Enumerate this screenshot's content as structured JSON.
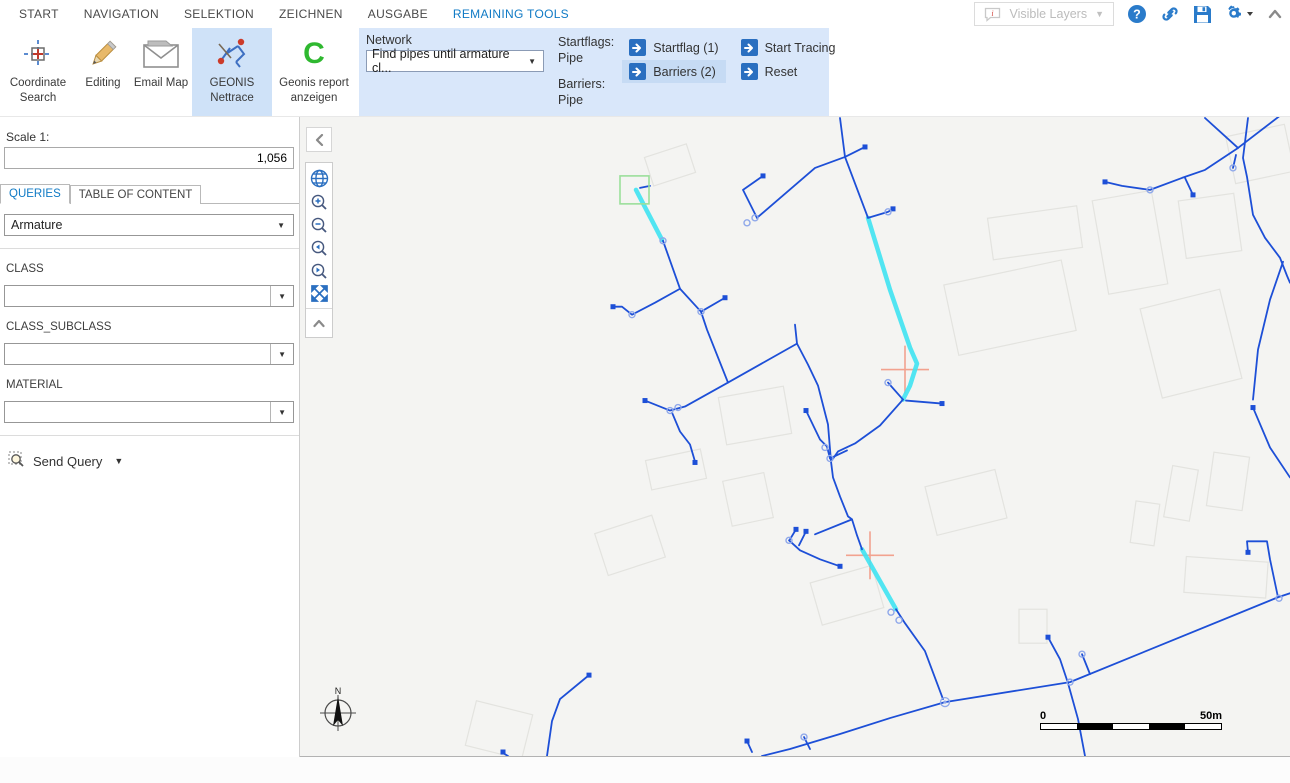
{
  "tabs": {
    "items": [
      "START",
      "NAVIGATION",
      "SELEKTION",
      "ZEICHNEN",
      "AUSGABE",
      "REMAINING TOOLS"
    ]
  },
  "titlebar": {
    "visible_layers_label": "Visible Layers"
  },
  "ribbon": {
    "tools": [
      {
        "label": "Coordinate Search"
      },
      {
        "label": "Editing"
      },
      {
        "label": "Email Map"
      },
      {
        "label": "GEONIS Nettrace"
      },
      {
        "label": "Geonis report anzeigen"
      }
    ],
    "geonis_c_letter": "C",
    "network": {
      "label": "Network",
      "dropdown_value": "Find pipes until armature cl...",
      "startflags_label": "Startflags:",
      "startflags_value": "Pipe",
      "barriers_label": "Barriers:",
      "barriers_value": "Pipe"
    },
    "buttons": [
      {
        "label": "Startflag (1)"
      },
      {
        "label": "Barriers (2)"
      },
      {
        "label": "Start Tracing"
      },
      {
        "label": "Reset"
      }
    ]
  },
  "left_panel": {
    "scale_label": "Scale 1:",
    "scale_value": "1,056",
    "tabs": [
      {
        "label": "QUERIES"
      },
      {
        "label": "TABLE OF CONTENT"
      }
    ],
    "query_select_value": "Armature",
    "fields": [
      {
        "label": "CLASS",
        "value": ""
      },
      {
        "label": "CLASS_SUBCLASS",
        "value": ""
      },
      {
        "label": "MATERIAL",
        "value": ""
      }
    ],
    "send_query_label": "Send Query"
  },
  "map": {
    "compass_label": "N",
    "scalebar": {
      "start": "0",
      "end": "50m"
    },
    "colors": {
      "line": "#1d4fd7",
      "cyan": "#3fe3f2",
      "circle": "#8fa8ea",
      "flag_green": "#9bdf9b",
      "barrier_red": "#f2a28f",
      "building": "#e3e3df"
    },
    "start_flag_box": {
      "x": 620,
      "y": 176,
      "w": 29,
      "h": 28
    },
    "crosshairs": [
      [
        905,
        370
      ],
      [
        870,
        556
      ]
    ],
    "cyan_lines": [
      [
        [
          636,
          190
        ],
        [
          662,
          240
        ]
      ],
      [
        [
          868,
          218
        ],
        [
          890,
          290
        ],
        [
          910,
          348
        ],
        [
          917,
          364
        ],
        [
          910,
          386
        ],
        [
          903,
          400
        ]
      ],
      [
        [
          862,
          550
        ],
        [
          896,
          610
        ]
      ]
    ],
    "blue_lines": [
      [
        [
          840,
          118
        ],
        [
          845,
          157
        ],
        [
          868,
          218
        ]
      ],
      [
        [
          845,
          157
        ],
        [
          815,
          168
        ],
        [
          757,
          218
        ]
      ],
      [
        [
          757,
          218
        ],
        [
          743,
          190
        ],
        [
          763,
          176
        ]
      ],
      [
        [
          845,
          157
        ],
        [
          865,
          147
        ]
      ],
      [
        [
          868,
          218
        ],
        [
          888,
          212
        ],
        [
          893,
          209
        ]
      ],
      [
        [
          663,
          241
        ],
        [
          680,
          289
        ],
        [
          701,
          312
        ],
        [
          707,
          330
        ],
        [
          728,
          383
        ]
      ],
      [
        [
          680,
          289
        ],
        [
          655,
          303
        ],
        [
          632,
          315
        ],
        [
          622,
          307
        ],
        [
          613,
          307
        ]
      ],
      [
        [
          701,
          312
        ],
        [
          725,
          298
        ]
      ],
      [
        [
          728,
          383
        ],
        [
          797,
          344
        ]
      ],
      [
        [
          795,
          325
        ],
        [
          797,
          344
        ],
        [
          808,
          365
        ],
        [
          818,
          386
        ],
        [
          828,
          425
        ],
        [
          831,
          462
        ]
      ],
      [
        [
          728,
          383
        ],
        [
          685,
          407
        ],
        [
          670,
          411
        ],
        [
          645,
          401
        ]
      ],
      [
        [
          672,
          413
        ],
        [
          680,
          432
        ],
        [
          690,
          445
        ],
        [
          695,
          462
        ]
      ],
      [
        [
          903,
          400
        ],
        [
          888,
          383
        ]
      ],
      [
        [
          906,
          401
        ],
        [
          942,
          404
        ]
      ],
      [
        [
          903,
          400
        ],
        [
          880,
          426
        ],
        [
          855,
          444
        ],
        [
          838,
          452
        ],
        [
          831,
          462
        ],
        [
          833,
          478
        ],
        [
          840,
          497
        ],
        [
          848,
          517
        ],
        [
          852,
          520
        ],
        [
          857,
          536
        ],
        [
          862,
          550
        ]
      ],
      [
        [
          852,
          520
        ],
        [
          815,
          535
        ]
      ],
      [
        [
          896,
          610
        ],
        [
          905,
          624
        ],
        [
          925,
          652
        ],
        [
          943,
          700
        ]
      ],
      [
        [
          789,
          541
        ],
        [
          800,
          551
        ],
        [
          820,
          560
        ],
        [
          840,
          567
        ]
      ],
      [
        [
          796,
          530
        ],
        [
          790,
          540
        ]
      ],
      [
        [
          806,
          532
        ],
        [
          799,
          546
        ]
      ],
      [
        [
          945,
          703
        ],
        [
          890,
          719
        ],
        [
          840,
          735
        ],
        [
          790,
          750
        ],
        [
          762,
          757
        ]
      ],
      [
        [
          945,
          703
        ],
        [
          1070,
          683
        ],
        [
          1278,
          598
        ]
      ],
      [
        [
          1278,
          598
        ],
        [
          1290,
          594
        ]
      ],
      [
        [
          1278,
          598
        ],
        [
          1270,
          560
        ],
        [
          1267,
          542
        ],
        [
          1247,
          542
        ],
        [
          1248,
          553
        ]
      ],
      [
        [
          1048,
          638
        ],
        [
          1060,
          660
        ],
        [
          1068,
          684
        ],
        [
          1078,
          720
        ],
        [
          1085,
          757
        ]
      ],
      [
        [
          1082,
          655
        ],
        [
          1086,
          665
        ],
        [
          1090,
          675
        ]
      ],
      [
        [
          589,
          676
        ],
        [
          560,
          700
        ],
        [
          552,
          722
        ],
        [
          547,
          757
        ]
      ],
      [
        [
          503,
          754
        ],
        [
          508,
          757
        ]
      ],
      [
        [
          747,
          742
        ],
        [
          752,
          753
        ]
      ],
      [
        [
          804,
          738
        ],
        [
          810,
          750
        ]
      ],
      [
        [
          1205,
          118
        ],
        [
          1238,
          148
        ]
      ],
      [
        [
          1238,
          148
        ],
        [
          1290,
          108
        ]
      ],
      [
        [
          1248,
          118
        ],
        [
          1243,
          158
        ],
        [
          1247,
          177
        ],
        [
          1253,
          215
        ],
        [
          1265,
          238
        ],
        [
          1280,
          258
        ],
        [
          1287,
          276
        ],
        [
          1290,
          283
        ]
      ],
      [
        [
          1283,
          262
        ],
        [
          1270,
          300
        ],
        [
          1258,
          350
        ],
        [
          1253,
          400
        ]
      ],
      [
        [
          1253,
          408
        ],
        [
          1270,
          448
        ],
        [
          1290,
          478
        ]
      ],
      [
        [
          1238,
          148
        ],
        [
          1205,
          170
        ],
        [
          1182,
          178
        ],
        [
          1150,
          190
        ],
        [
          1122,
          186
        ],
        [
          1105,
          182
        ]
      ],
      [
        [
          1185,
          178
        ],
        [
          1193,
          195
        ]
      ],
      [
        [
          1236,
          155
        ],
        [
          1233,
          168
        ]
      ],
      [
        [
          640,
          188
        ],
        [
          650,
          186
        ]
      ],
      [
        [
          806,
          411
        ],
        [
          820,
          440
        ],
        [
          827,
          447
        ],
        [
          830,
          459
        ]
      ],
      [
        [
          830,
          459
        ],
        [
          847,
          451
        ]
      ]
    ],
    "squares": [
      [
        865,
        147
      ],
      [
        893,
        209
      ],
      [
        763,
        176
      ],
      [
        725,
        298
      ],
      [
        613,
        307
      ],
      [
        645,
        401
      ],
      [
        695,
        463
      ],
      [
        942,
        404
      ],
      [
        806,
        411
      ],
      [
        589,
        676
      ],
      [
        503,
        753
      ],
      [
        747,
        742
      ],
      [
        840,
        567
      ],
      [
        796,
        530
      ],
      [
        806,
        532
      ],
      [
        1048,
        638
      ],
      [
        1193,
        195
      ],
      [
        1248,
        553
      ],
      [
        1253,
        408
      ],
      [
        1105,
        182
      ]
    ],
    "circles": [
      [
        663,
        241
      ],
      [
        888,
        212
      ],
      [
        755,
        218
      ],
      [
        747,
        223
      ],
      [
        701,
        312
      ],
      [
        632,
        315
      ],
      [
        670,
        411
      ],
      [
        678,
        408
      ],
      [
        888,
        383
      ],
      [
        825,
        448
      ],
      [
        830,
        459
      ],
      [
        891,
        613
      ],
      [
        899,
        621
      ],
      [
        789,
        541
      ],
      [
        804,
        738
      ],
      [
        1082,
        655
      ],
      [
        1070,
        683
      ],
      [
        1279,
        599
      ],
      [
        1233,
        168
      ],
      [
        1150,
        190
      ]
    ],
    "double_circles": [
      [
        945,
        703
      ]
    ],
    "buildings": [
      [
        648,
        150,
        44,
        30,
        -18
      ],
      [
        950,
        272,
        120,
        72,
        -12
      ],
      [
        1100,
        195,
        60,
        95,
        -10
      ],
      [
        1182,
        197,
        56,
        58,
        -8
      ],
      [
        1230,
        130,
        60,
        48,
        -12
      ],
      [
        990,
        212,
        90,
        42,
        -8
      ],
      [
        1150,
        298,
        82,
        92,
        -14
      ],
      [
        1168,
        468,
        26,
        52,
        10
      ],
      [
        1210,
        455,
        36,
        54,
        8
      ],
      [
        1185,
        560,
        82,
        36,
        4
      ],
      [
        1019,
        610,
        28,
        34,
        0
      ],
      [
        815,
        574,
        64,
        44,
        -16
      ],
      [
        722,
        392,
        66,
        48,
        -10
      ],
      [
        648,
        455,
        56,
        30,
        -12
      ],
      [
        600,
        524,
        60,
        44,
        -18
      ],
      [
        470,
        708,
        58,
        46,
        14
      ],
      [
        930,
        478,
        72,
        50,
        -14
      ],
      [
        727,
        477,
        42,
        46,
        -12
      ],
      [
        1133,
        503,
        24,
        42,
        8
      ]
    ]
  }
}
